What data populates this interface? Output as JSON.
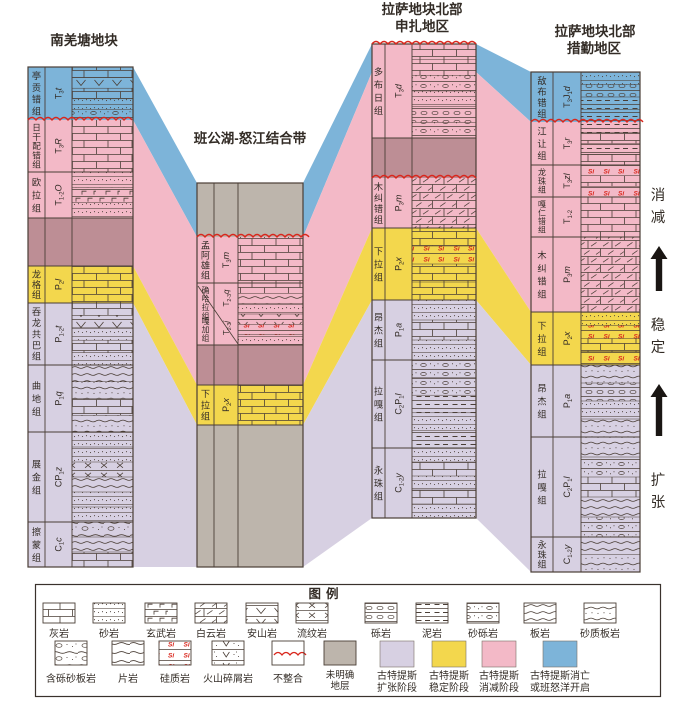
{
  "figure": {
    "width": 700,
    "height": 702
  },
  "colors": {
    "blue": "#7db4d9",
    "pink": "#f3b9c7",
    "mauve": "#bd8e95",
    "yellow": "#f3d74d",
    "lavender": "#d7d0e2",
    "gray": "#bdb5ac",
    "line": "#4a3e36",
    "red": "#d9261c",
    "text": "#332c26"
  },
  "columns": [
    {
      "id": "south-qiangtang",
      "title_lines": [
        "南羌塘地块"
      ],
      "title_pos": [
        [
          84,
          45
        ]
      ],
      "x": 28,
      "label_w": 17,
      "code_w": 27,
      "lith_w": 61,
      "top": 67,
      "top_unconformity": false,
      "units": [
        {
          "name": "亭贡错组",
          "code": [
            [
              "T",
              "n"
            ],
            [
              "3",
              "s"
            ],
            [
              "t",
              "i"
            ]
          ],
          "color": "blue",
          "h": 53,
          "lith": [
            "limestone",
            "andesite",
            "limestone",
            "sandstone",
            "sandy-conglomerate"
          ],
          "unconformity_below": true
        },
        {
          "name": "日干配错组",
          "code": [
            [
              "T",
              "n"
            ],
            [
              "3",
              "s"
            ],
            [
              "R",
              "i"
            ]
          ],
          "color": "pink",
          "h": 52,
          "lith": [
            "limestone"
          ]
        },
        {
          "name": "欧拉组",
          "code": [
            [
              "T",
              "n"
            ],
            [
              "1-2",
              "s"
            ],
            [
              "O",
              "i"
            ]
          ],
          "color": "pink",
          "h": 46,
          "lith": [
            "sandstone",
            "basalt",
            "sandstone"
          ]
        },
        {
          "name": null,
          "color": "mauve",
          "h": 48
        },
        {
          "name": "龙格组",
          "code": [
            [
              "P",
              "n"
            ],
            [
              "2",
              "s"
            ],
            [
              "l",
              "i"
            ]
          ],
          "color": "yellow",
          "h": 37,
          "lith": [
            "limestone"
          ]
        },
        {
          "name": "吞龙共巴组",
          "code": [
            [
              "P",
              "n"
            ],
            [
              "1-2",
              "s"
            ],
            [
              "t",
              "i"
            ]
          ],
          "color": "lavender",
          "h": 62,
          "lith": [
            "limestone",
            "andesite",
            "sandstone",
            "limestone",
            "sandstone"
          ]
        },
        {
          "name": "曲地组",
          "code": [
            [
              "P",
              "n"
            ],
            [
              "1",
              "s"
            ],
            [
              "q",
              "i"
            ]
          ],
          "color": "lavender",
          "h": 67,
          "lith": [
            "slate",
            "sandy-slate",
            "limestone",
            "sandy-slate"
          ]
        },
        {
          "name": "展金组",
          "code": [
            [
              "CP",
              "n"
            ],
            [
              "1",
              "s"
            ],
            [
              "z",
              "i"
            ]
          ],
          "color": "lavender",
          "h": 90,
          "lith": [
            "sandstone",
            "sandstone",
            "rhyolite",
            "slate",
            "sandstone",
            "sandstone"
          ]
        },
        {
          "name": "擦蒙组",
          "code": [
            [
              "C",
              "n"
            ],
            [
              "1",
              "s"
            ],
            [
              "c",
              "i"
            ]
          ],
          "color": "lavender",
          "h": 45,
          "lith": [
            "pebbly-sandy-slate",
            "slate",
            "limestone"
          ]
        }
      ]
    },
    {
      "id": "bangong-nujiang",
      "title_lines": [
        "班公湖-怒江结合带"
      ],
      "title_pos": [
        [
          250,
          143
        ]
      ],
      "x": 197,
      "label_w": 17,
      "code_w": 24,
      "lith_w": 65,
      "top": 183,
      "top_unconformity": false,
      "units": [
        {
          "name": null,
          "color": "gray",
          "h": 54,
          "unconformity_below": true
        },
        {
          "name": "孟阿雄组",
          "code": [
            [
              "T",
              "n"
            ],
            [
              "3",
              "s"
            ],
            [
              "m",
              "i"
            ]
          ],
          "color": "pink",
          "h": 46,
          "lith": [
            "limestone"
          ]
        },
        {
          "name": "确哈拉组",
          "name2": "嘎加组",
          "split": true,
          "code": [
            [
              "T",
              "n"
            ],
            [
              "2-3",
              "s"
            ],
            [
              "q",
              "i"
            ]
          ],
          "code2": [
            [
              "T",
              "n"
            ],
            [
              "2-3",
              "s"
            ],
            [
              "j",
              "i"
            ]
          ],
          "color": "pink",
          "h": 62,
          "lith": [
            "limestone",
            "slate",
            "sandstone",
            "andesite",
            "siliceous",
            "sandstone"
          ]
        },
        {
          "name": null,
          "color": "mauve",
          "h": 40
        },
        {
          "name": "下拉组",
          "code": [
            [
              "P",
              "n"
            ],
            [
              "2",
              "s"
            ],
            [
              "x",
              "i"
            ]
          ],
          "color": "yellow",
          "h": 40,
          "lith": [
            "limestone"
          ]
        },
        {
          "name": null,
          "color": "gray",
          "h": 142
        }
      ]
    },
    {
      "id": "lhasa-north-xainza",
      "title_lines": [
        "拉萨地块北部",
        "申扎地区"
      ],
      "title_pos": [
        [
          422,
          14
        ],
        [
          422,
          31
        ]
      ],
      "x": 372,
      "label_w": 13,
      "code_w": 27,
      "lith_w": 64,
      "top": 44,
      "top_unconformity": true,
      "units": [
        {
          "name": "多布日组",
          "code": [
            [
              "T",
              "n"
            ],
            [
              "3",
              "s"
            ],
            [
              "d",
              "i"
            ]
          ],
          "color": "pink",
          "h": 94,
          "lith": [
            "limestone",
            "limestone",
            "sandy-conglomerate",
            "sandstone",
            "conglomerate",
            "sandy-conglomerate"
          ]
        },
        {
          "name": null,
          "color": "mauve",
          "h": 40,
          "unconformity_below": true
        },
        {
          "name": "木纠错组",
          "code": [
            [
              "P",
              "n"
            ],
            [
              "3",
              "s"
            ],
            [
              "m",
              "i"
            ]
          ],
          "color": "pink",
          "h": 50,
          "lith": [
            "dolomite"
          ]
        },
        {
          "name": "下拉组",
          "code": [
            [
              "P",
              "n"
            ],
            [
              "2",
              "s"
            ],
            [
              "x",
              "i"
            ]
          ],
          "color": "yellow",
          "h": 72,
          "lith": [
            "limestone",
            "siliceous",
            "limestone",
            "limestone"
          ]
        },
        {
          "name": "昂杰组",
          "code": [
            [
              "P",
              "n"
            ],
            [
              "1",
              "s"
            ],
            [
              "a",
              "i"
            ]
          ],
          "color": "lavender",
          "h": 60,
          "lith": [
            "sandstone",
            "limestone",
            "sandstone"
          ]
        },
        {
          "name": "拉嘎组",
          "code": [
            [
              "C",
              "n"
            ],
            [
              "2",
              "s"
            ],
            [
              "P",
              "n"
            ],
            [
              "1",
              "s"
            ],
            [
              "l",
              "i"
            ]
          ],
          "color": "lavender",
          "h": 88,
          "lith": [
            "sandy-conglomerate",
            "sandy-conglomerate",
            "mudstone",
            "sandstone",
            "mudstone"
          ]
        },
        {
          "name": "永珠组",
          "code": [
            [
              "C",
              "n"
            ],
            [
              "1-2",
              "s"
            ],
            [
              "y",
              "i"
            ]
          ],
          "color": "lavender",
          "h": 70,
          "lith": [
            "sandstone",
            "limestone",
            "sandstone",
            "limestone",
            "sandstone"
          ]
        }
      ]
    },
    {
      "id": "lhasa-north-coqen",
      "title_lines": [
        "拉萨地块北部",
        "措勤地区"
      ],
      "title_pos": [
        [
          595,
          36
        ],
        [
          594,
          53
        ]
      ],
      "x": 531,
      "label_w": 22,
      "code_w": 28,
      "lith_w": 59,
      "top": 72,
      "top_unconformity": false,
      "units": [
        {
          "name": "敌布错组",
          "code": [
            [
              "T",
              "n"
            ],
            [
              "3",
              "s"
            ],
            [
              "J",
              "n"
            ],
            [
              "1",
              "s"
            ],
            [
              "d",
              "i"
            ]
          ],
          "color": "blue",
          "h": 50,
          "lith": [
            "sandstone",
            "conglomerate",
            "mudstone",
            "mudstone"
          ],
          "unconformity_below": true
        },
        {
          "name": "江让组",
          "code": [
            [
              "T",
              "n"
            ],
            [
              "3",
              "s"
            ],
            [
              "r",
              "i"
            ]
          ],
          "color": "pink",
          "h": 43,
          "lith": [
            "mudstone",
            "limestone",
            "mudstone",
            "limestone"
          ]
        },
        {
          "name": "龙珠组",
          "code": [
            [
              "T",
              "n"
            ],
            [
              "3",
              "s"
            ],
            [
              "zl",
              "i"
            ]
          ],
          "color": "pink",
          "h": 32,
          "lith": [
            "siliceous",
            "limestone",
            "siliceous"
          ]
        },
        {
          "name": "嘎仁错组",
          "code": [
            [
              "T",
              "n"
            ],
            [
              "1-2",
              "s"
            ]
          ],
          "color": "pink",
          "h": 40,
          "lith": [
            "limestone"
          ]
        },
        {
          "name": "木纠错组",
          "code": [
            [
              "P",
              "n"
            ],
            [
              "3",
              "s"
            ],
            [
              "m",
              "i"
            ]
          ],
          "color": "pink",
          "h": 75,
          "lith": [
            "dolomite"
          ]
        },
        {
          "name": "下拉组",
          "code": [
            [
              "P",
              "n"
            ],
            [
              "2",
              "s"
            ],
            [
              "x",
              "i"
            ]
          ],
          "color": "yellow",
          "h": 53,
          "lith": [
            "sandstone",
            "siliceous",
            "limestone",
            "siliceous"
          ]
        },
        {
          "name": "昂杰组",
          "code": [
            [
              "P",
              "n"
            ],
            [
              "1",
              "s"
            ],
            [
              "a",
              "i"
            ]
          ],
          "color": "lavender",
          "h": 72,
          "lith": [
            "sandy-slate",
            "conglomerate",
            "sandstone",
            "sandy-slate"
          ]
        },
        {
          "name": "拉嘎组",
          "code": [
            [
              "C",
              "n"
            ],
            [
              "2",
              "s"
            ],
            [
              "P",
              "n"
            ],
            [
              "1",
              "s"
            ],
            [
              "l",
              "i"
            ]
          ],
          "color": "lavender",
          "h": 100,
          "lith": [
            "sandy-slate",
            "sandy-conglomerate",
            "limestone",
            "slate",
            "sandy-conglomerate"
          ]
        },
        {
          "name": "永珠组",
          "code": [
            [
              "C",
              "n"
            ],
            [
              "1-2",
              "s"
            ],
            [
              "y",
              "i"
            ]
          ],
          "color": "lavender",
          "h": 35,
          "lith": [
            "slate",
            "sandy-slate"
          ]
        }
      ]
    }
  ],
  "annotations": [
    {
      "id": "subduction",
      "text": "消减",
      "x": 658,
      "y": 200
    },
    {
      "id": "stable",
      "text": "稳定",
      "x": 658,
      "y": 330
    },
    {
      "id": "expansion",
      "text": "扩张",
      "x": 658,
      "y": 485
    }
  ],
  "legend": {
    "title": "图例",
    "row1": [
      {
        "label": "灰岩",
        "pattern": "limestone"
      },
      {
        "label": "砂岩",
        "pattern": "sandstone"
      },
      {
        "label": "玄武岩",
        "pattern": "basalt"
      },
      {
        "label": "白云岩",
        "pattern": "dolomite"
      },
      {
        "label": "安山岩",
        "pattern": "andesite"
      },
      {
        "label": "流纹岩",
        "pattern": "rhyolite"
      },
      {
        "label": "砾岩",
        "pattern": "conglomerate"
      },
      {
        "label": "泥岩",
        "pattern": "mudstone"
      },
      {
        "label": "砂砾岩",
        "pattern": "sandy-conglomerate"
      },
      {
        "label": "板岩",
        "pattern": "slate"
      },
      {
        "label": "砂质板岩",
        "pattern": "sandy-slate"
      }
    ],
    "row2": [
      {
        "label": "含砾砂板岩",
        "pattern": "pebbly-sandy-slate"
      },
      {
        "label": "片岩",
        "pattern": "schist"
      },
      {
        "label": "硅质岩",
        "pattern": "siliceous"
      },
      {
        "label": "火山碎屑岩",
        "pattern": "volcaniclastic"
      },
      {
        "label": "不整合",
        "pattern": "unconformity"
      },
      {
        "label_lines": [
          "未明确",
          "地层"
        ],
        "pattern": "unclear"
      }
    ],
    "stages": [
      {
        "label_lines": [
          "古特提斯",
          "扩张阶段"
        ],
        "color": "lavender"
      },
      {
        "label_lines": [
          "古特提斯",
          "稳定阶段"
        ],
        "color": "yellow"
      },
      {
        "label_lines": [
          "古特提斯",
          "消减阶段"
        ],
        "color": "pink"
      },
      {
        "label_lines": [
          "古特提斯消亡",
          "或班怒洋开启"
        ],
        "color": "blue"
      }
    ]
  }
}
